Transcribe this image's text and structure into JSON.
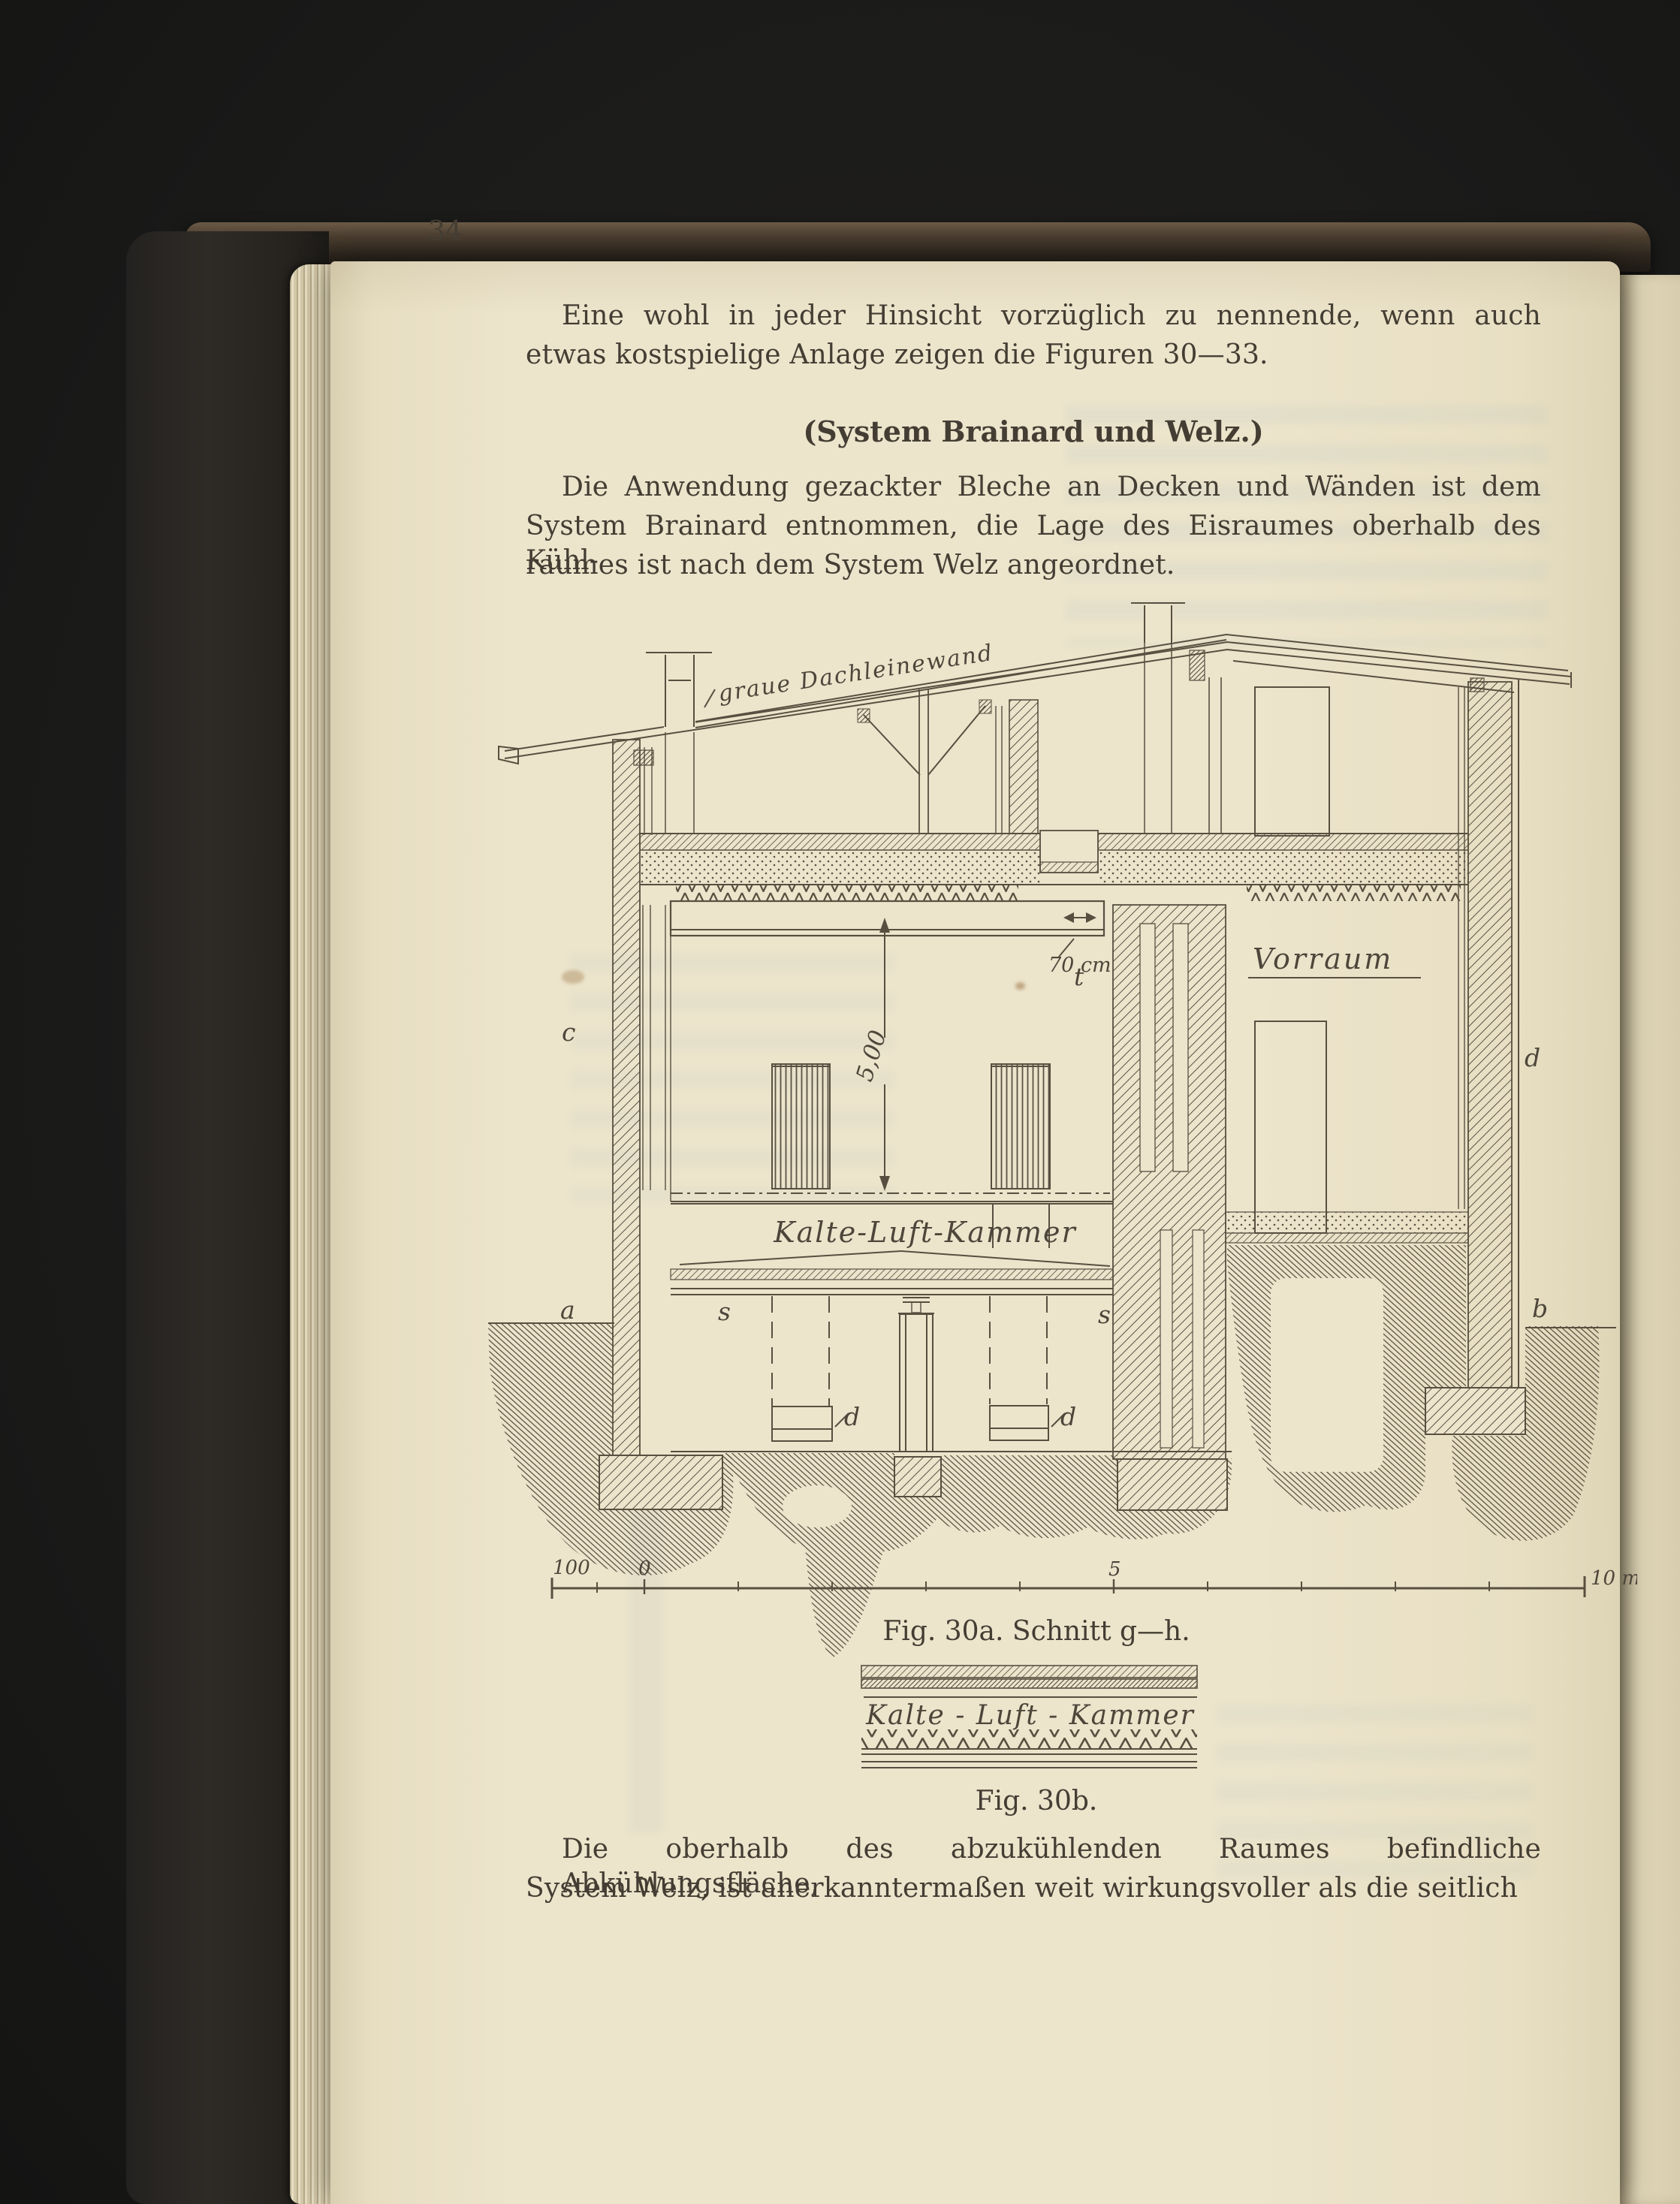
{
  "colors": {
    "paper": "#ece4cb",
    "ink": "#443d33",
    "figure_line": "#584f40",
    "cover": "#2e2b27",
    "background": "#1b1b1a"
  },
  "page": {
    "number": "34"
  },
  "text": {
    "para1": {
      "line1": "Eine wohl in jeder Hinsicht vorzüglich zu nennende, wenn auch",
      "line2": "etwas kostspielige Anlage zeigen die Figuren 30—33."
    },
    "heading": "(System Brainard und Welz.)",
    "para2": {
      "line1": "Die Anwendung gezackter Bleche an Decken und Wänden ist dem",
      "line2": "System Brainard entnommen, die Lage des Eisraumes oberhalb des Kühl-",
      "line3": "raumes ist nach dem System Welz angeordnet."
    },
    "para3": {
      "line1": "Die oberhalb des abzukühlenden Raumes befindliche Abkühlungsfläche,",
      "line2": "System Welz, ist anerkanntermaßen weit wirkungsvoller als die seitlich"
    }
  },
  "figure_30a": {
    "caption": "Fig. 30a. Schnitt g—h.",
    "roof_label": "graue Dachleinewand",
    "vorraum_label": "Vorraum",
    "cold_air_chamber_label": "Kalte-Luft-Kammer",
    "height_dim": "5,00",
    "duct_dim": "70 cm",
    "letters": {
      "a": "a",
      "b": "b",
      "c": "c",
      "d_wall": "d",
      "d_left": "d",
      "d_right": "d",
      "s_left": "s",
      "s_right": "s",
      "t": "t"
    },
    "scale": {
      "hundred": "100",
      "zero": "0",
      "five": "5",
      "ten": "10 m."
    }
  },
  "figure_30b": {
    "label": "Kalte - Luft - Kammer",
    "caption": "Fig. 30b."
  }
}
